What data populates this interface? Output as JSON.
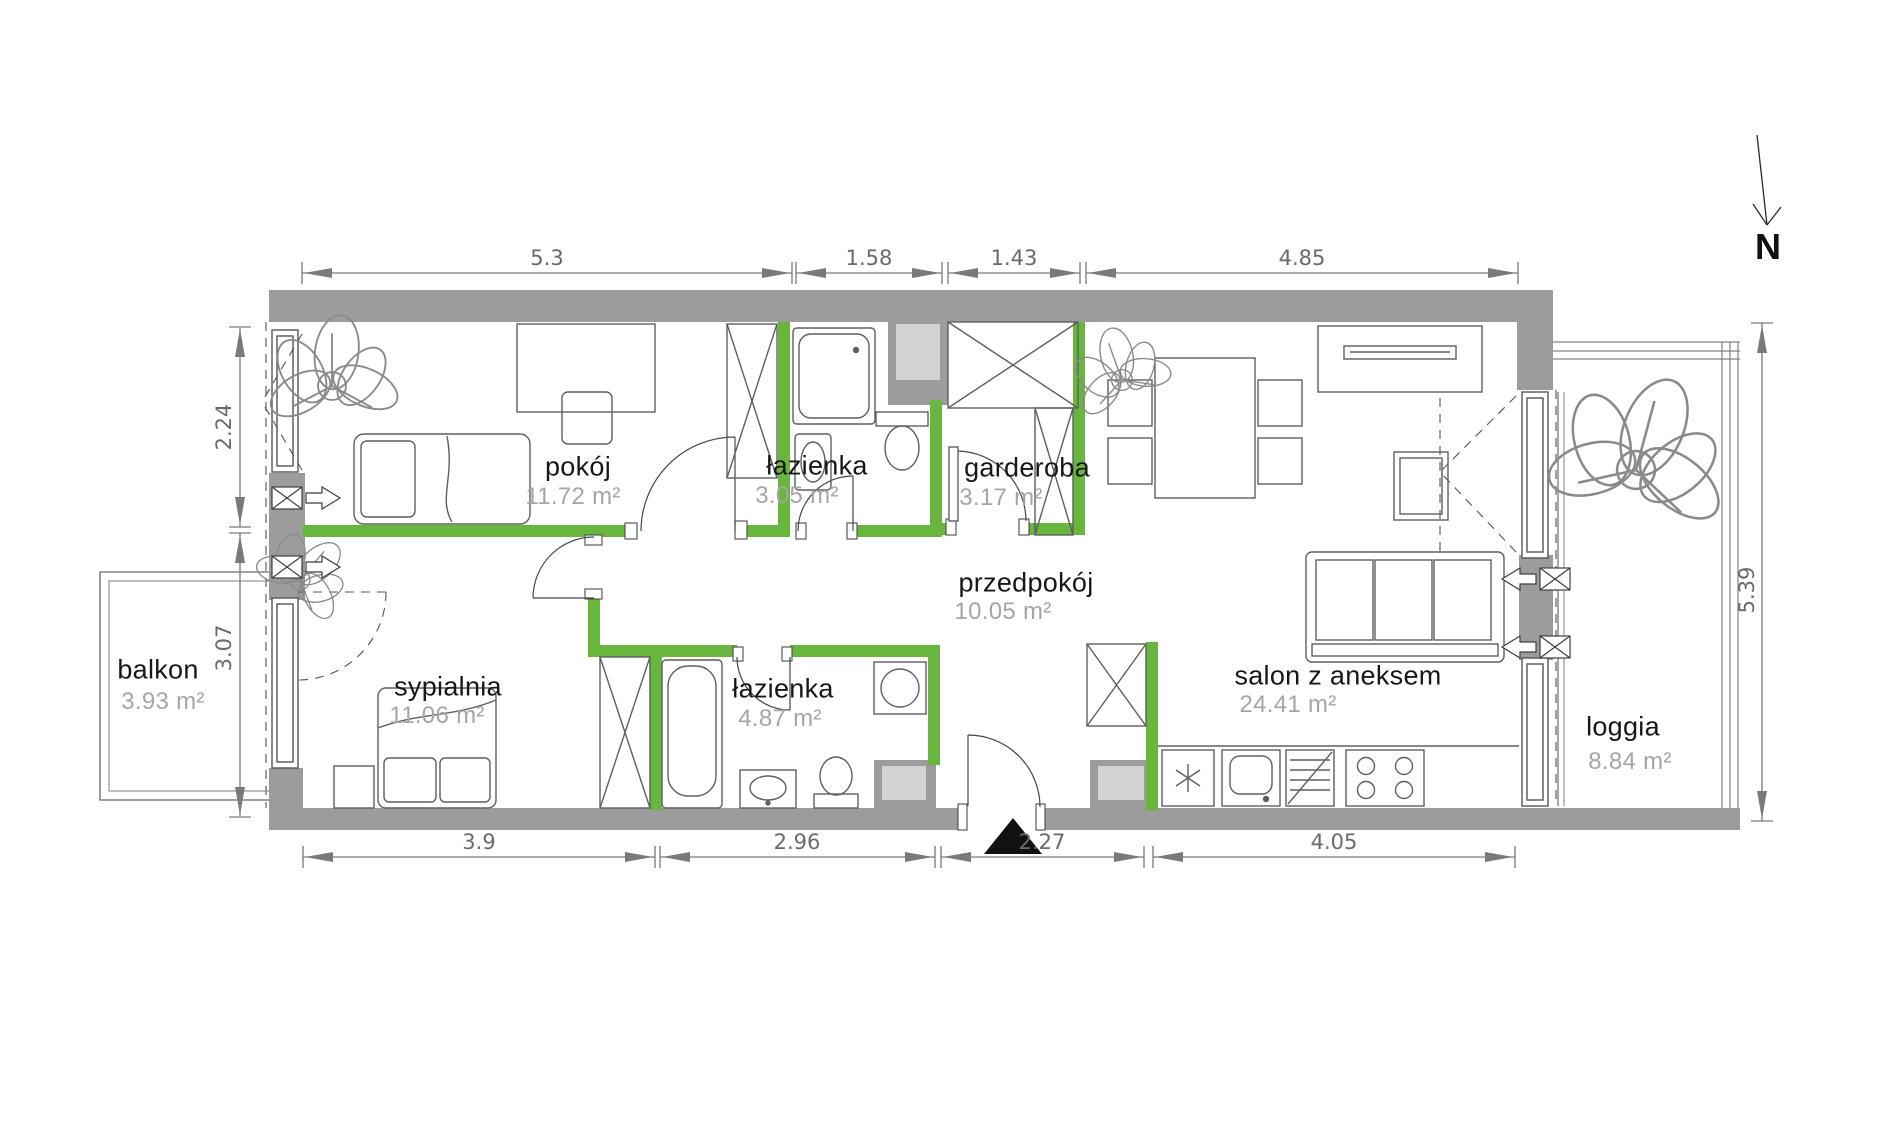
{
  "compass": {
    "label": "N"
  },
  "rooms": {
    "pokoj": {
      "name": "pokój",
      "area": "11.72 m²"
    },
    "lazienka_gorna": {
      "name": "łazienka",
      "area": "3.05 m²"
    },
    "garderoba": {
      "name": "garderoba",
      "area": "3.17 m²"
    },
    "przedpokoj": {
      "name": "przedpokój",
      "area": "10.05 m²"
    },
    "sypialnia": {
      "name": "sypialnia",
      "area": "11.06 m²"
    },
    "lazienka_dolna": {
      "name": "łazienka",
      "area": "4.87 m²"
    },
    "salon": {
      "name": "salon z aneksem",
      "area": "24.41 m²"
    },
    "balkon": {
      "name": "balkon",
      "area": "3.93 m²"
    },
    "loggia": {
      "name": "loggia",
      "area": "8.84 m²"
    }
  },
  "dimensions": {
    "top": [
      "5.3",
      "1.58",
      "1.43",
      "4.85"
    ],
    "bottom": [
      "3.9",
      "2.96",
      "2.27",
      "4.05"
    ],
    "left": [
      "2.24",
      "3.07"
    ],
    "right": [
      "5.39"
    ]
  },
  "colors": {
    "wall": "#9c9c9c",
    "partition": "#68b63e",
    "shaft": "#d2d2d2",
    "dimension": "#7a7a7a",
    "room_label": "#171717",
    "area_label": "#a5a5a5",
    "entrance_marker": "#111111"
  }
}
